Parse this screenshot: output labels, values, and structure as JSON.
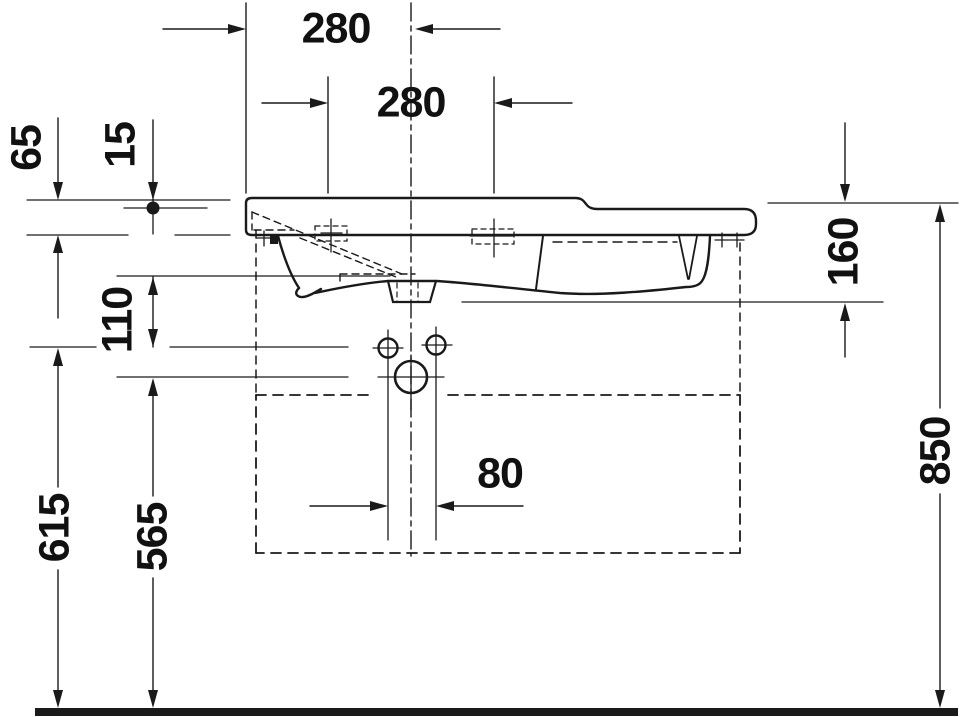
{
  "drawing": {
    "type": "washbasin-side-elevation-technical-drawing",
    "units": "mm",
    "dimensions": {
      "bowl_center_from_left_edge": "280",
      "fixing_hole_spacing": "280",
      "rim_to_fixing_level": "65",
      "rim_to_tap_hole": "15",
      "underside_to_fixing_holes": "110",
      "basin_depth": "160",
      "fixing_bolt_height": "615",
      "trap_outlet_height": "565",
      "bolt_hole_spacing": "80",
      "rim_height_above_floor": "850"
    },
    "line_color": "#1a1a1a",
    "background_color": "#ffffff"
  }
}
